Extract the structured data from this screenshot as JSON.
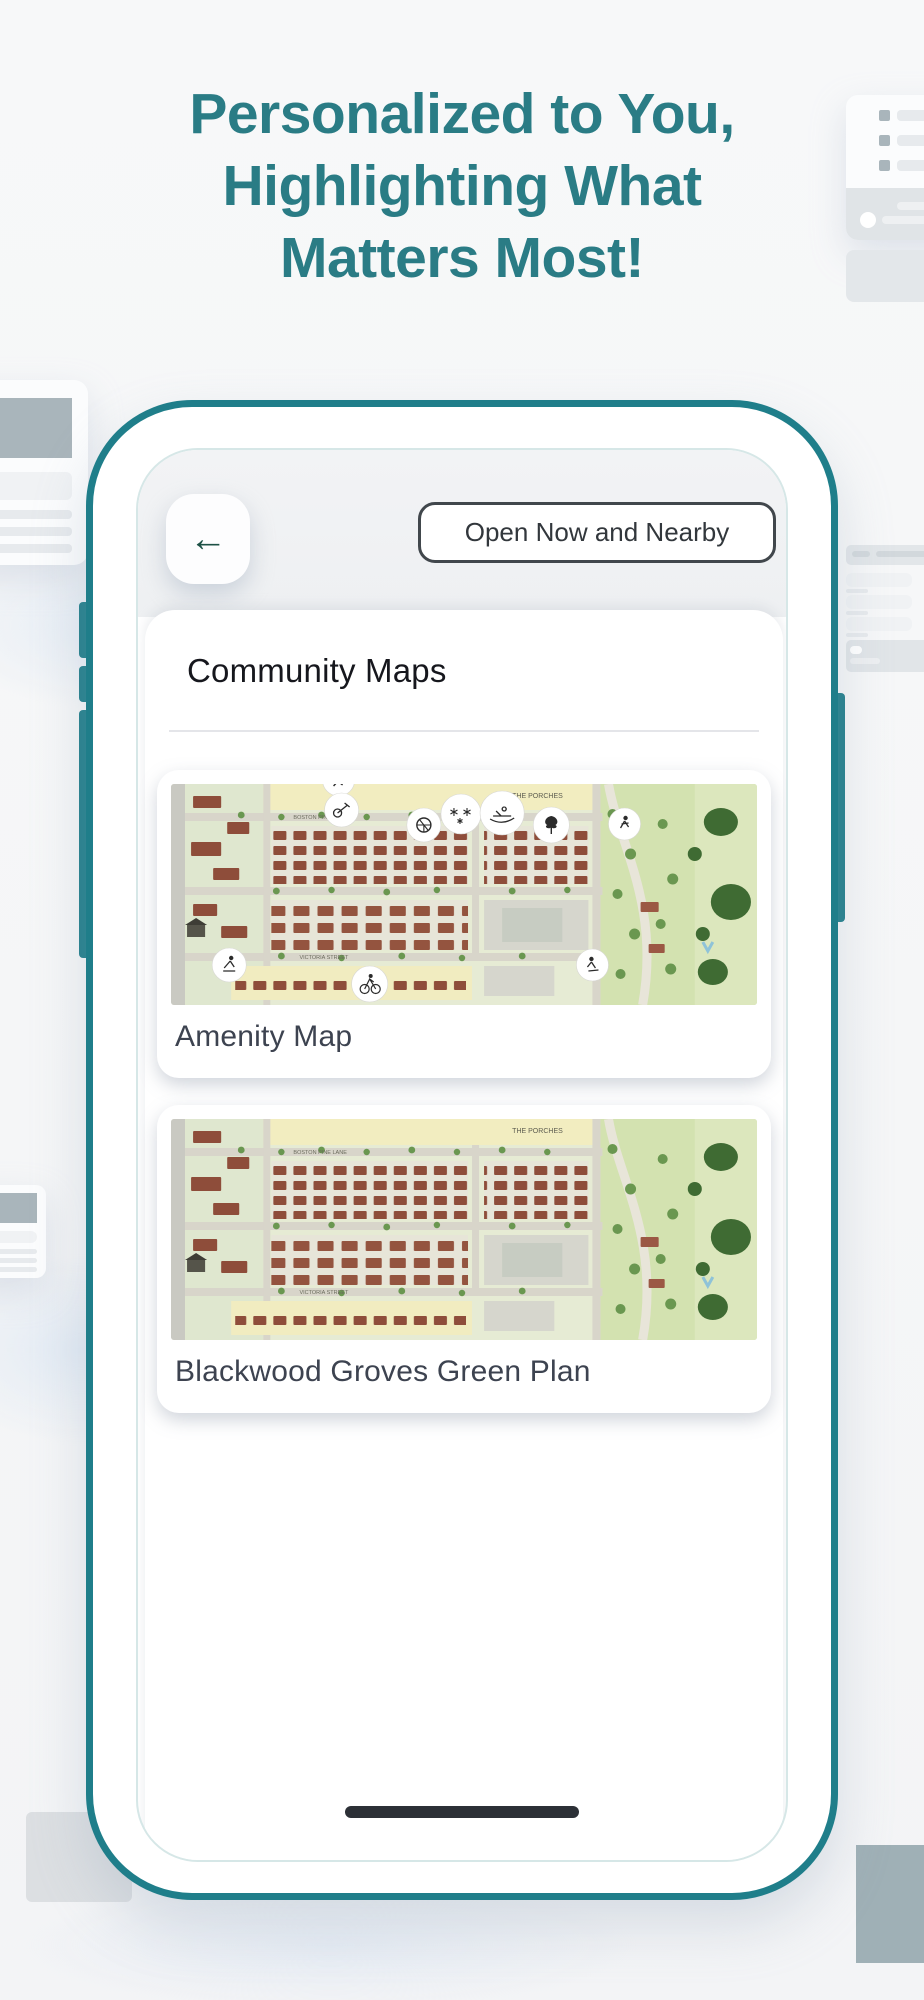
{
  "headline": {
    "line1": "Personalized to You,",
    "line2": "Highlighting What",
    "line3": "Matters Most!"
  },
  "phone": {
    "back_button_glyph": "←",
    "filter_button_label": "Open Now and Nearby",
    "section_header": "Community Maps",
    "map_cards": [
      {
        "label": "Amenity Map"
      },
      {
        "label": "Blackwood Groves Green Plan"
      }
    ]
  },
  "map_illustration_labels": {
    "street_top": "BOSTON PINE LANE",
    "district": "THE PORCHES",
    "street_bottom": "VICTORIA STREET"
  },
  "colors": {
    "accent_teal": "#1f7e8a",
    "headline_teal": "#2a7c85",
    "back_arrow_green": "#1d5146"
  }
}
